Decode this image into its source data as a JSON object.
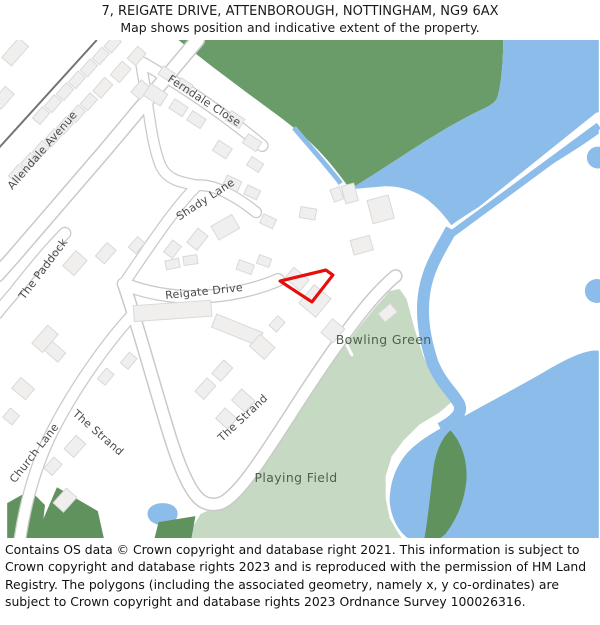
{
  "header": {
    "line1": "7, REIGATE DRIVE, ATTENBOROUGH, NOTTINGHAM, NG9 6AX",
    "line2": "Map shows position and indicative extent of the property."
  },
  "map": {
    "street_labels": {
      "allendale": "Allendale Avenue",
      "ferndale": "Ferndale Close",
      "shady": "Shady Lane",
      "paddock": "The Paddock",
      "reigate": "Reigate Drive",
      "church": "Church Lane",
      "strand_west": "The Strand",
      "strand_east": "The Strand"
    },
    "area_labels": {
      "bowling_green": "Bowling Green",
      "playing_field": "Playing Field"
    },
    "property": {
      "outline_color": "#e60d0d"
    },
    "colors": {
      "woodland": "#6a9c6a",
      "water": "#8cbce9",
      "playing_field": "#c6d9c2",
      "trees": "#5f925c",
      "building": "#f0efee",
      "road_casing": "#c9c9c9"
    }
  },
  "footer": {
    "text": "Contains OS data © Crown copyright and database right 2021. This information is subject to Crown copyright and database rights 2023 and is reproduced with the permission of HM Land Registry. The polygons (including the associated geometry, namely x, y co-ordinates) are subject to Crown copyright and database rights 2023 Ordnance Survey 100026316."
  }
}
